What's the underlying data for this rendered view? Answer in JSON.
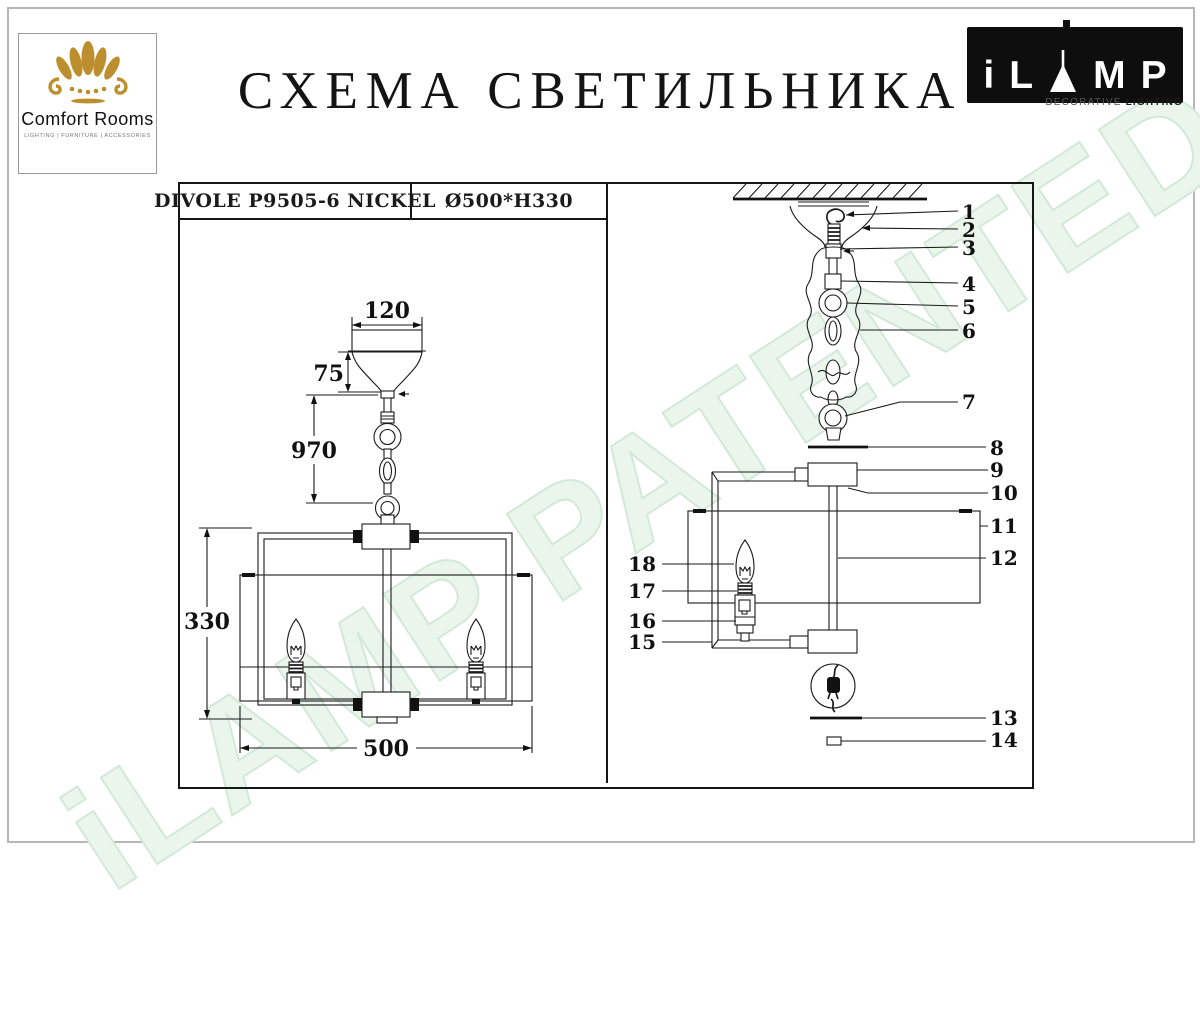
{
  "page": {
    "brand_logo": {
      "name": "Comfort Rooms",
      "tagline": "LIGHTING  |  FURNITURE  |  ACCESSORIES"
    },
    "title": "СХЕМА СВЕТИЛЬНИКА",
    "ilamp_logo": {
      "letters": [
        "i",
        "L",
        "M",
        "P"
      ],
      "tagline_left": "DECORATIVE ",
      "tagline_right": "LIGHTING"
    },
    "watermark": "iLAMP PATENTED"
  },
  "spec_table": {
    "model": "DIVOLE P9505-6 NICKEL",
    "dimensions": "Ø500*H330"
  },
  "overview_diagram": {
    "dim_canopy_width": "120",
    "dim_canopy_height": "75",
    "dim_suspension": "970",
    "dim_body_height": "330",
    "dim_body_width": "500"
  },
  "parts_diagram": {
    "callouts_right": [
      "1",
      "2",
      "3",
      "4",
      "5",
      "6",
      "7",
      "8",
      "9",
      "10",
      "11",
      "12",
      "13",
      "14"
    ],
    "callouts_left": [
      "15",
      "16",
      "17",
      "18"
    ]
  },
  "colors": {
    "accent_gold": "#bd8e2e",
    "line": "#1a1a1a",
    "watermark_green": "#d3e9d8"
  }
}
